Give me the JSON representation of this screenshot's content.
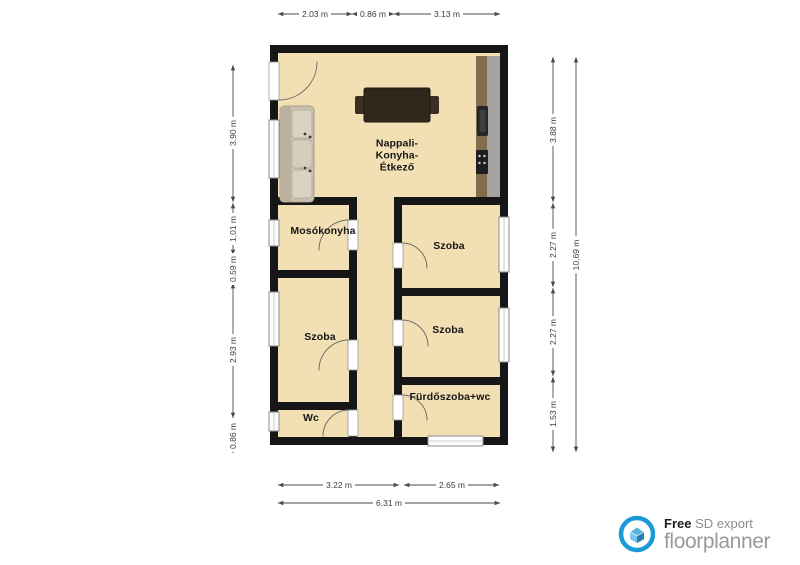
{
  "rooms": {
    "living": "Nappali-\nKonyha-\nÉtkező",
    "laundry": "Mosókonyha",
    "bedroom_top_right": "Szoba",
    "bedroom_mid_right": "Szoba",
    "bedroom_left": "Szoba",
    "wc": "Wc",
    "bathroom": "Fürdőszoba+wc"
  },
  "dimensions": {
    "top": [
      "2.03 m",
      "0.86 m",
      "3.13 m"
    ],
    "left": [
      "3.90 m",
      "1.01 m",
      "0.59 m",
      "2.93 m",
      "0.86 m"
    ],
    "right": [
      "3.88 m",
      "2.27 m",
      "2.27 m",
      "1.53 m"
    ],
    "right_total": "10.69 m",
    "bottom": [
      "3.22 m",
      "2.65 m"
    ],
    "bottom_total": "6.31 m"
  },
  "branding": {
    "free_label": "Free",
    "export_label": "SD export",
    "brand_name": "floorplanner"
  },
  "colors": {
    "floor": "#f2dfb4",
    "wall": "#161616",
    "brand_blue": "#1a9ad6",
    "dimension_text": "#3d3d3d"
  }
}
